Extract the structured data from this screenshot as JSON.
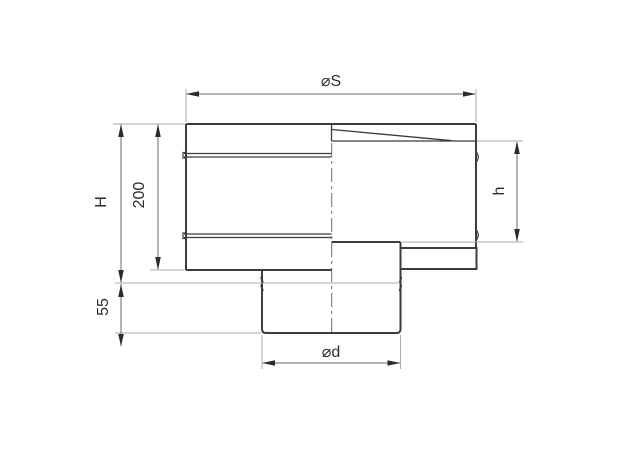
{
  "drawing": {
    "title": "pipe-adapter-technical-drawing",
    "background_color": "#ffffff",
    "body_line_color": "#3c3c3c",
    "dimension_line_color": "#6a6a6a",
    "extension_line_color": "#ababab",
    "text_color": "#2c2c2c",
    "labels": {
      "top_diameter": "⌀S",
      "total_height": "H",
      "body_height": "200",
      "inner_height": "h",
      "spigot_length": "55",
      "bottom_diameter": "⌀d"
    }
  }
}
